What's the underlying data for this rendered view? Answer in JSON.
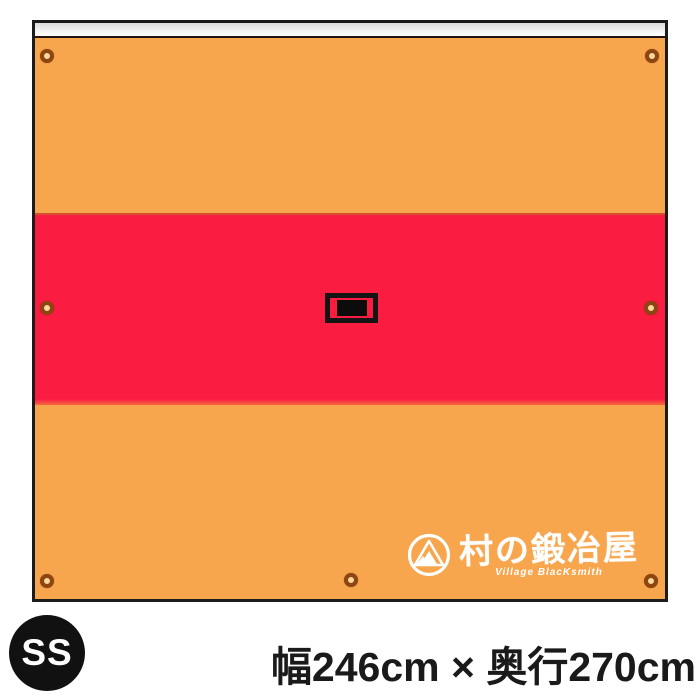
{
  "colors": {
    "sheet_orange": "#F8A64E",
    "stripe_red": "#FA1C41",
    "border_black": "#1B1B1B",
    "top_hem_gray": "#E8E8E8",
    "grommet_brown": "#8E4510",
    "badge_black": "#111111",
    "text_black": "#1A1A1A",
    "logo_white": "#FFFFFF"
  },
  "tarp": {
    "description": "ground-sheet illustration with orange body, red center stripe, gray top hem",
    "grommet_count": 7,
    "icons": {
      "grommet": "grommet-eyelet-icon",
      "emblem": "mountain-circle-emblem-icon",
      "handle": "carry-handle-icon"
    },
    "logo": {
      "brand_jp": "村の鍛冶屋",
      "brand_en": "Village BlacKsmith"
    }
  },
  "size_badge": {
    "label": "SS"
  },
  "caption": {
    "dimensions": "幅246cm × 奥行270cm"
  }
}
